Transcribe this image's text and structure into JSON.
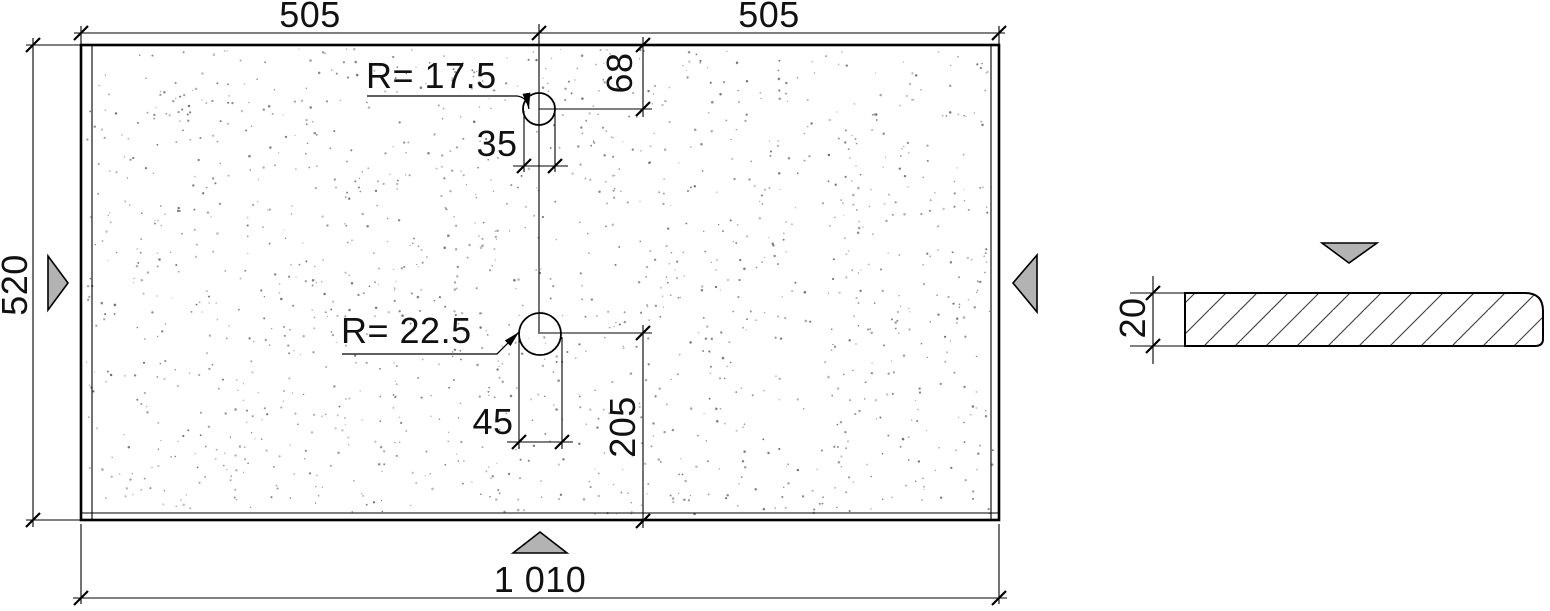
{
  "drawing": {
    "plan_view": {
      "dim_width_left": "505",
      "dim_width_right": "505",
      "dim_height": "520",
      "dim_total_width": "1 010",
      "hole_top": {
        "radius_label": "R= 17.5",
        "offset_from_top": "68",
        "diameter": "35"
      },
      "hole_middle": {
        "radius_label": "R= 22.5",
        "diameter": "45",
        "offset_from_bottom": "205"
      }
    },
    "section_view": {
      "thickness": "20"
    },
    "icons": {
      "left_marker": "view-direction-triangle-right",
      "right_marker": "view-direction-triangle-left",
      "bottom_marker": "view-direction-triangle-up",
      "section_marker": "view-direction-triangle-down"
    },
    "colors": {
      "line": "#000000",
      "marker_fill": "#b3b3b3",
      "stipple": "#555555",
      "hatch": "#3a3a3a",
      "background": "#ffffff"
    }
  }
}
